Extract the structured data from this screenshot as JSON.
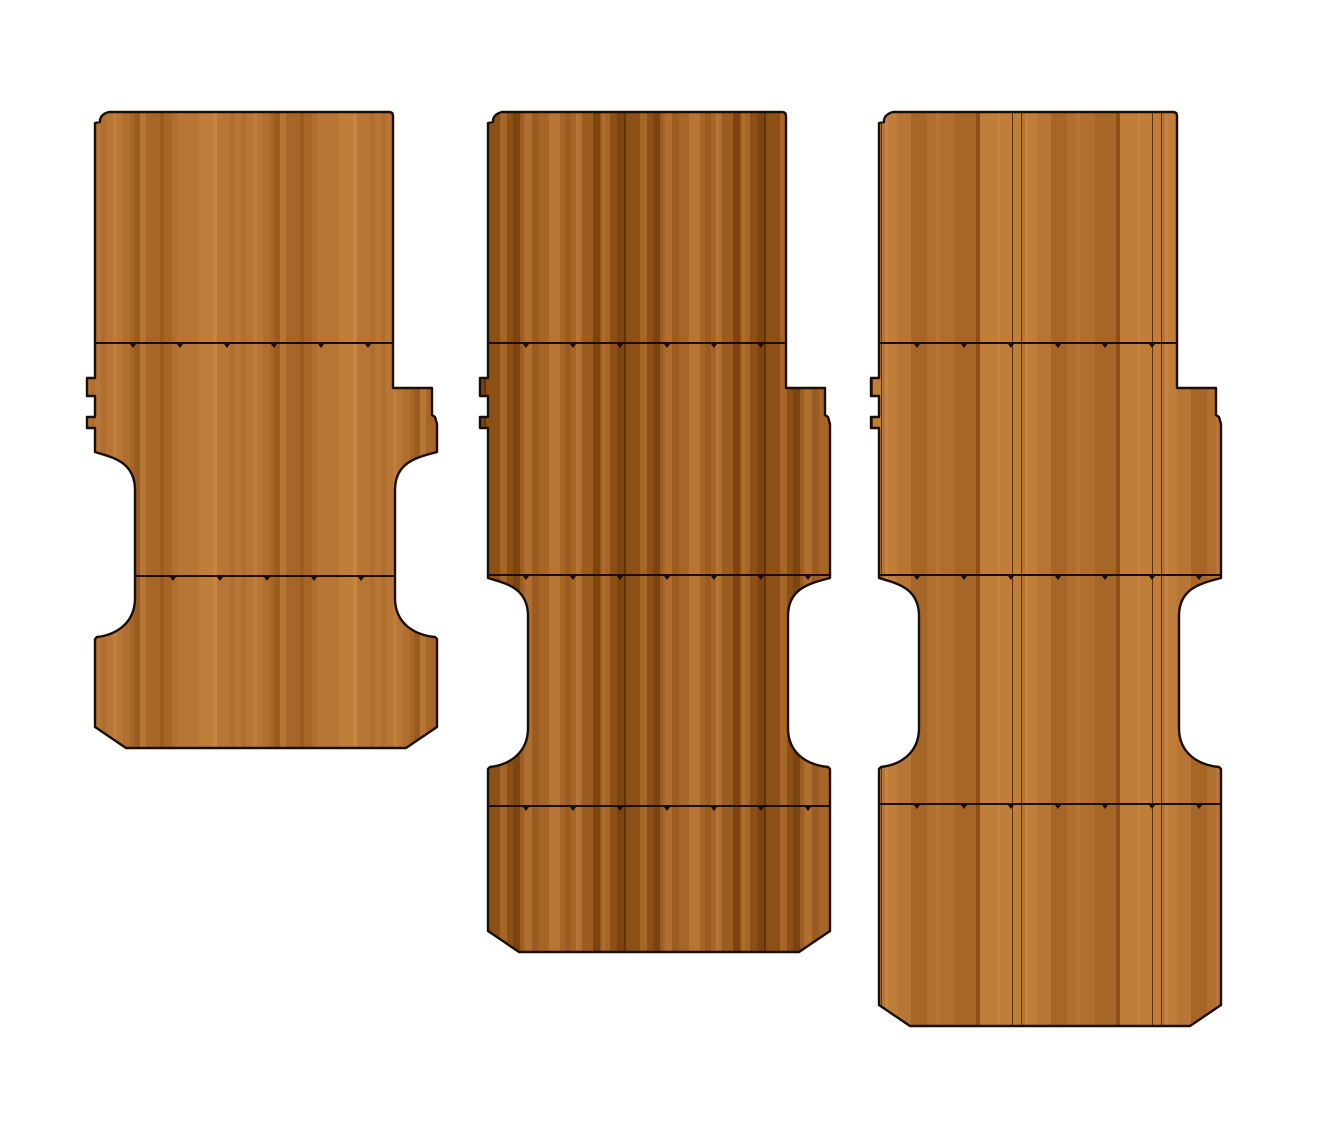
{
  "canvas": {
    "width": 1317,
    "height": 1138,
    "background": "#ffffff"
  },
  "drawing": {
    "outline_color": "#1b0f05",
    "seam_color": "#1b0f05",
    "wood_base": "#c07e3b",
    "wood_palette": [
      "#d4954f",
      "#cd8c47",
      "#c68542",
      "#c07e3b",
      "#b87636",
      "#b06e2f",
      "#a66628",
      "#9a5c20",
      "#8c5017",
      "#7c4410"
    ],
    "wood_streak": "#5f3408",
    "profile": {
      "top": 112,
      "notch_inset": 14,
      "tab_depth": 8,
      "tab1": [
        378,
        396
      ],
      "tab2": [
        417,
        428
      ],
      "right_step_y": 388,
      "right_step2_y": 415,
      "right_step2_chamfer_y": 424,
      "arch_inset_left": 40,
      "arch_inset_right": 42,
      "chamfer_w": 31,
      "chamfer_h": 21,
      "tick_spacing": 47,
      "tick_offset": 38
    },
    "panels": [
      {
        "name": "floor-panel-left-short",
        "x0": 95,
        "x1": 393,
        "x2": 437,
        "bottom": 748,
        "arch_top": 452,
        "arch_bottom": 638,
        "grain_seed": 7,
        "seams": [
          {
            "y": 343,
            "from": "left",
            "to": "topRight"
          },
          {
            "y": 576,
            "from": "waistLeft",
            "to": "waistRight"
          }
        ]
      },
      {
        "name": "floor-panel-middle-medium",
        "x0": 488,
        "x1": 786,
        "x2": 830,
        "bottom": 952,
        "arch_top": 578,
        "arch_bottom": 768,
        "grain_seed": 19,
        "seams": [
          {
            "y": 343,
            "from": "left",
            "to": "topRight"
          },
          {
            "y": 575,
            "from": "left",
            "to": "outerRight"
          },
          {
            "y": 806,
            "from": "left",
            "to": "outerRight"
          }
        ]
      },
      {
        "name": "floor-panel-right-long",
        "x0": 879,
        "x1": 1177,
        "x2": 1221,
        "bottom": 1026,
        "arch_top": 578,
        "arch_bottom": 768,
        "grain_seed": 33,
        "seams": [
          {
            "y": 343,
            "from": "left",
            "to": "topRight"
          },
          {
            "y": 575,
            "from": "left",
            "to": "outerRight"
          },
          {
            "y": 804,
            "from": "left",
            "to": "outerRight"
          }
        ]
      }
    ]
  }
}
